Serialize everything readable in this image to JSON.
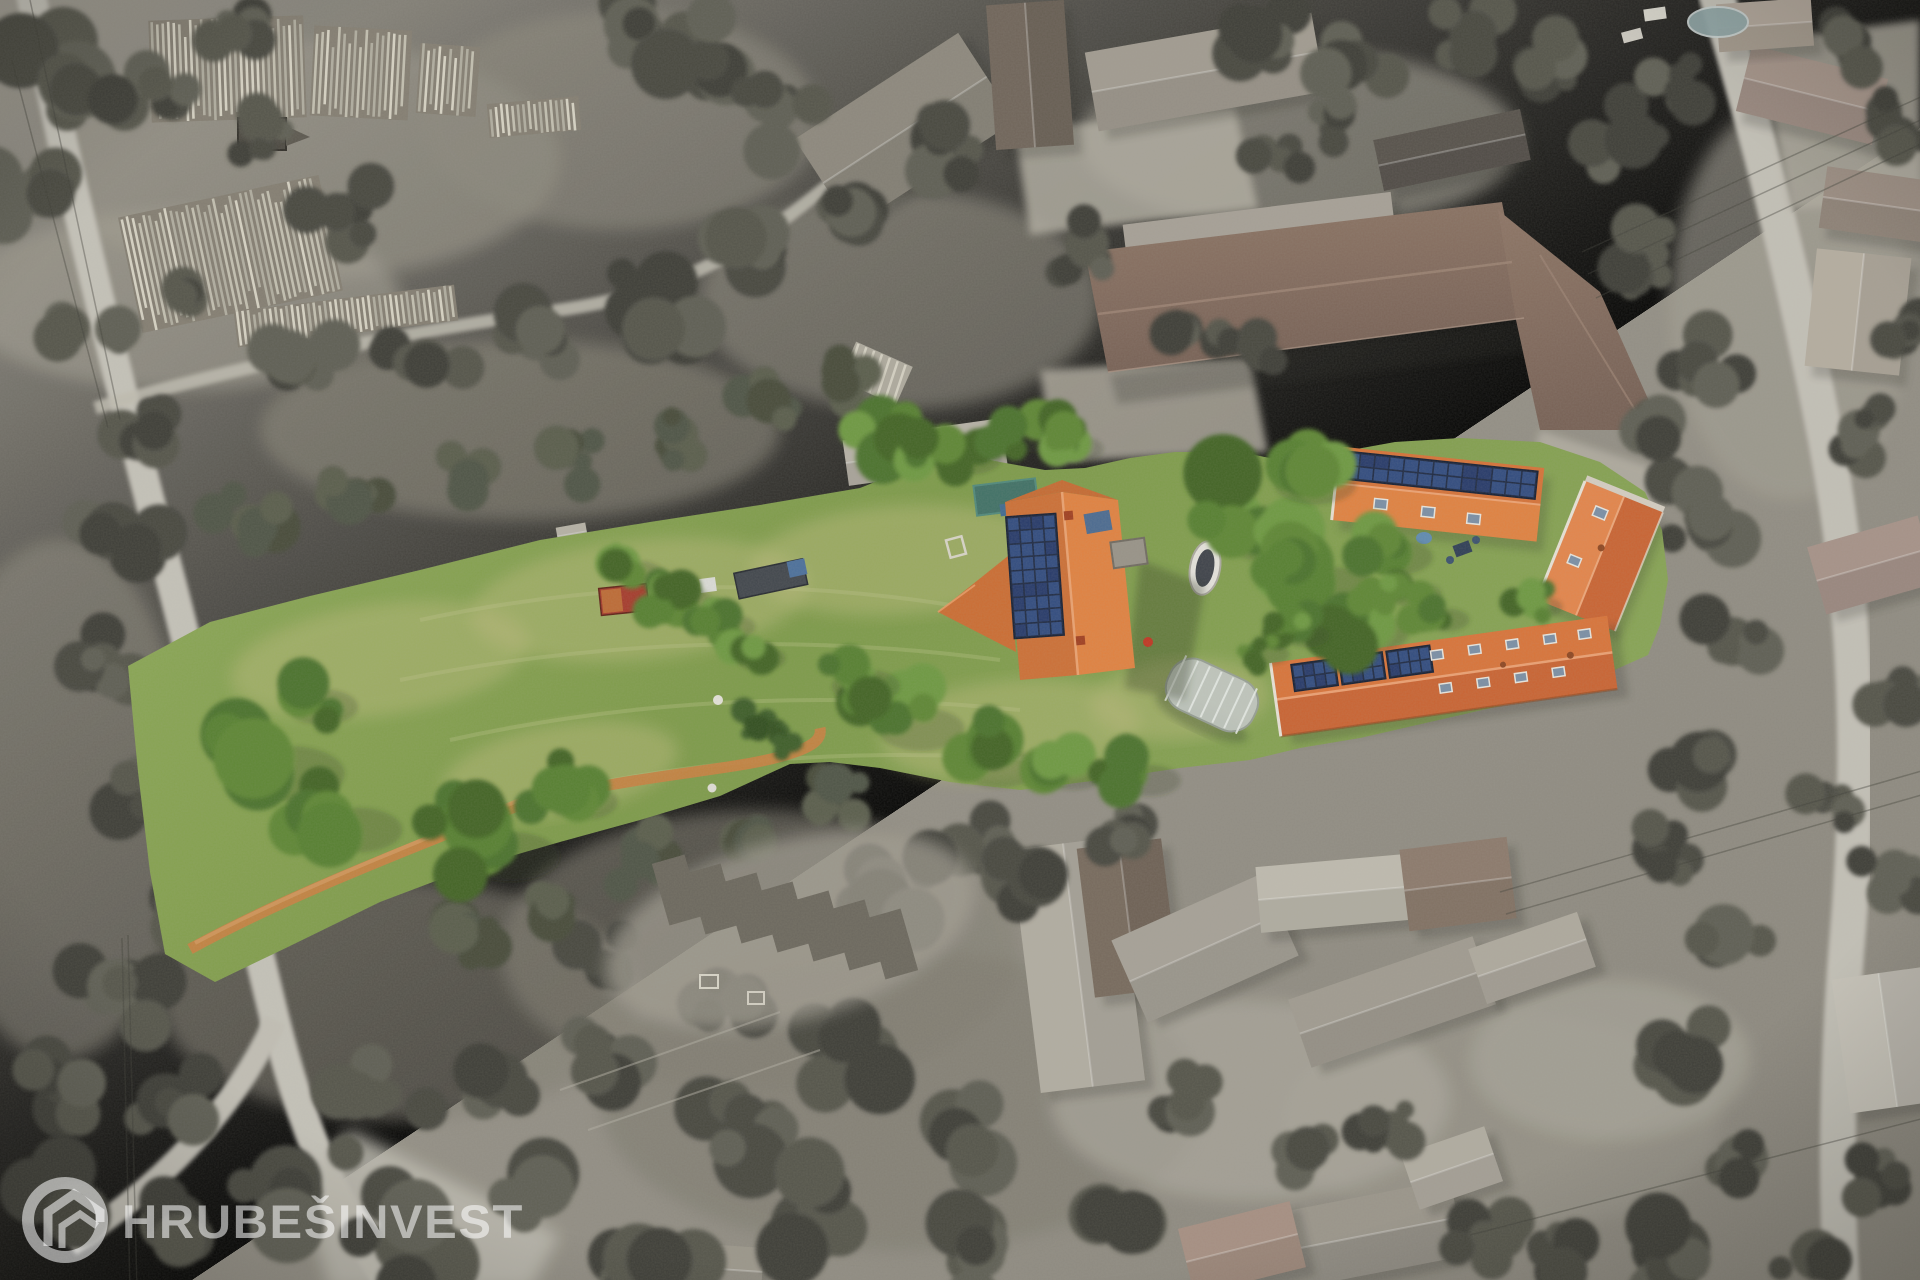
{
  "watermark": {
    "brand_text": "HRUBEŠINVEST",
    "logo_icon": "house-ring-icon"
  },
  "colors": {
    "roof_orange": "#dd7438",
    "roof_orange_light": "#e5823f",
    "roof_orange_dark": "#cd6330",
    "solar_panel_dark": "#1b2742",
    "solar_panel_cell": "#2e4a80",
    "meadow_green": "#7fa04b",
    "meadow_green_light": "#93ab5c",
    "dry_grass": "#b9bb79",
    "tree_green": "#4a7229",
    "dirt_path_orange": "#c8823f",
    "desaturated_gray": "#97938a",
    "road_gray": "#c7c4bb",
    "barn_brown": "#85695b",
    "watermark_white": "rgba(255,255,255,0.55)"
  }
}
